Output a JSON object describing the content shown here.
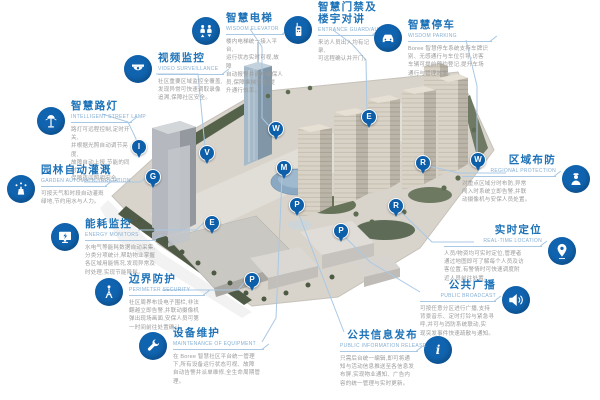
{
  "colors": {
    "primary_blue": "#1063ae",
    "title_blue": "#1e73b8",
    "subtitle_blue": "#86b0d5",
    "connector_blue": "#a9c8e4",
    "desc_gray": "#9b9b9b",
    "pin_blue": "#0e5fa9"
  },
  "callouts": [
    {
      "id": "video-surveillance",
      "title": "视频监控",
      "subtitle": "VIDEO SURVEILLANCE",
      "icon": "dome-camera-icon",
      "desc": [
        "社区重要区域监控全覆盖,",
        "发现异常可快速调取录像",
        "追溯,保障社区安全。"
      ]
    },
    {
      "id": "intelligent-street-lamp",
      "title": "智慧路灯",
      "subtitle": "INTELLIGENT STREET LAMP",
      "icon": "street-lamp-icon",
      "desc": [
        "路灯可远程控制,定时开关,",
        "并根据光照自动调节亮度,",
        "故障自动上报,节能的同时",
        "保障夜间照明安全。"
      ]
    },
    {
      "id": "garden-automatic-irrigation",
      "title": "园林自动灌溉",
      "subtitle": "GARDEN AUTOMATIC IRRIGATION",
      "icon": "sprinkler-icon",
      "desc": [
        "可按天气和时段自动灌溉",
        "绿地,节约用水与人力。"
      ]
    },
    {
      "id": "energy-monitors",
      "title": "能耗监控",
      "subtitle": "ENERGY MONITORS",
      "icon": "monitor-icon",
      "desc": [
        "水电气等能耗数据自动采集,",
        "分类分项统计,帮助物业掌握",
        "各区域用能情况,发现异常及",
        "时处理,实现节能降耗。"
      ]
    },
    {
      "id": "perimeter-security",
      "title": "边界防护",
      "subtitle": "PERIMETER SECURITY",
      "icon": "watchtower-icon",
      "desc": [
        "社区周界布设电子围栏,非法",
        "翻越立即告警,并联动摄像机",
        "弹出现场画面,安保人员可第",
        "一时间前往处置确认。"
      ]
    },
    {
      "id": "maintenance-of-equipment",
      "title": "设备维护",
      "subtitle": "MAINTENANCE OF EQUIPMENT",
      "icon": "wrench-icon",
      "desc": [
        "在 Boree 智慧社区平台统一管理",
        "下,所有设备运行状态可视、故障",
        "自动告警并派单维修,全生命周期管理。"
      ]
    },
    {
      "id": "wisdom-elevator",
      "title": "智慧电梯",
      "subtitle": "WISDOM ELEVATOR",
      "icon": "elevator-icon",
      "desc": [
        "楼内电梯统一接入平台,",
        "运行状态实时可视,故障",
        "自动报警并通知维保人",
        "员,保障乘梯安全,提",
        "升通行效率。"
      ]
    },
    {
      "id": "entrance-guard",
      "title": "智慧门禁及",
      "title2": "楼宇对讲",
      "subtitle": "ENTRANCE GUARD/AUDIO",
      "icon": "intercom-icon",
      "desc": [
        "来访人员出入均有记录,",
        "可远程确认并开门。"
      ]
    },
    {
      "id": "wisdom-parking",
      "title": "智慧停车",
      "subtitle": "WISDOM PARKING",
      "icon": "car-icon",
      "desc": [
        "Boree 智慧停车系统支持车牌识",
        "别、无感通行与车位引导,访客",
        "车辆可提前预约登记,提升车场",
        "通行与管理效率。"
      ]
    },
    {
      "id": "regional-protection",
      "title": "区域布防",
      "subtitle": "REGIONAL PROTECTION",
      "icon": "guard-icon",
      "desc": [
        "对重点区域分时布防,异常",
        "闯入时系统立即告警,并联",
        "动摄像机与安保人员处置。"
      ]
    },
    {
      "id": "real-time-location",
      "title": "实时定位",
      "subtitle": "REAL-TIME LOCATION",
      "icon": "location-pin-icon",
      "desc": [
        "人员/物资均可实时定位,管理者",
        "通过地图即可了解每个人员及访",
        "客位置,有警情时可快速调度附",
        "近人员前往处置。"
      ]
    },
    {
      "id": "public-broadcast",
      "title": "公共广播",
      "subtitle": "PUBLIC BROADCAST",
      "icon": "megaphone-icon",
      "desc": [
        "可按任意分区进行广播,支持",
        "背景音乐、定时打铃与紧急寻",
        "呼,并可与消防系统联动,实",
        "现突发事件快速疏散与通知。"
      ]
    },
    {
      "id": "public-information-release",
      "title": "公共信息发布",
      "subtitle": "PUBLIC INFORMATION RELEASE",
      "icon": "info-icon",
      "desc": [
        "只需后台统一编辑,即可将通",
        "知与活动信息推送至各信息发",
        "布屏,实现物业通知、广告内",
        "容的统一管理与实时更新。"
      ]
    }
  ],
  "pins": [
    {
      "letter": "V",
      "x": 206,
      "y": 152
    },
    {
      "letter": "I",
      "x": 138,
      "y": 146
    },
    {
      "letter": "G",
      "x": 152,
      "y": 176
    },
    {
      "letter": "E",
      "x": 211,
      "y": 222
    },
    {
      "letter": "P",
      "x": 251,
      "y": 279
    },
    {
      "letter": "M",
      "x": 283,
      "y": 167
    },
    {
      "letter": "W",
      "x": 275,
      "y": 128
    },
    {
      "letter": "E",
      "x": 368,
      "y": 116
    },
    {
      "letter": "W",
      "x": 477,
      "y": 159
    },
    {
      "letter": "R",
      "x": 422,
      "y": 162
    },
    {
      "letter": "R",
      "x": 395,
      "y": 205
    },
    {
      "letter": "P",
      "x": 340,
      "y": 230
    },
    {
      "letter": "P",
      "x": 296,
      "y": 204
    }
  ]
}
